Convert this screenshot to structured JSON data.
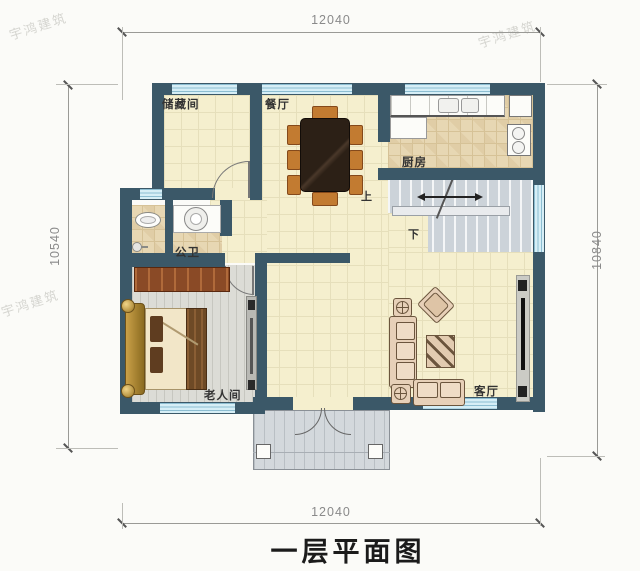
{
  "title": "一层平面图",
  "watermark": "宇鸿建筑",
  "dimensions": {
    "top": "12040",
    "bottom": "12040",
    "left": "10540",
    "right": "10840"
  },
  "rooms": {
    "storage": "储藏间",
    "dining": "餐厅",
    "kitchen": "厨房",
    "bathroom": "公卫",
    "elder_bedroom": "老人间",
    "living": "客厅"
  },
  "stairs": {
    "up": "上",
    "down": "下"
  },
  "colors": {
    "wall": "#3b5868",
    "floor_tile": "#f5efce",
    "kitchen_floor": "#e7d7b3",
    "bedroom_floor": "#dcdcd6",
    "window_glass": "#d6eef6",
    "stair_floor": "#ccd3d9",
    "wood_furniture": "#8a4a26",
    "sofa": "#e7d0b8",
    "dimension_text": "#8a8a8a"
  }
}
